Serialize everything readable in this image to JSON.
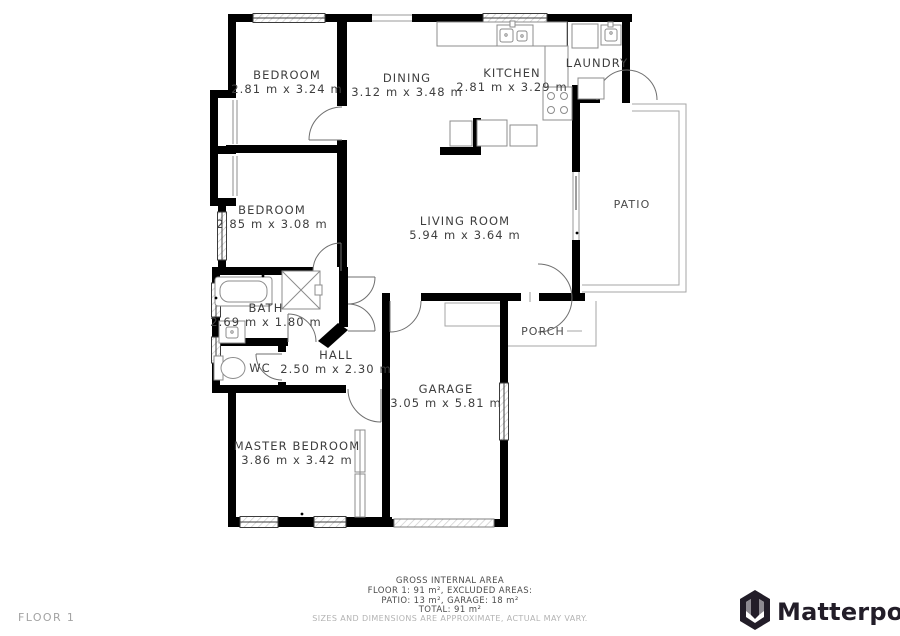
{
  "plan": {
    "rooms": [
      {
        "id": "bedroom-1",
        "name": "BEDROOM",
        "dims": "2.81 m x 3.24 m"
      },
      {
        "id": "dining",
        "name": "DINING",
        "dims": "3.12 m x 3.48 m"
      },
      {
        "id": "kitchen",
        "name": "KITCHEN",
        "dims": "2.81 m x 3.29 m"
      },
      {
        "id": "laundry",
        "name": "LAUNDRY",
        "dims": ""
      },
      {
        "id": "bedroom-2",
        "name": "BEDROOM",
        "dims": "2.85 m x 3.08 m"
      },
      {
        "id": "living-room",
        "name": "LIVING ROOM",
        "dims": "5.94 m x 3.64 m"
      },
      {
        "id": "patio",
        "name": "PATIO",
        "dims": ""
      },
      {
        "id": "bath",
        "name": "BATH",
        "dims": "2.69 m x 1.80 m"
      },
      {
        "id": "wc",
        "name": "WC",
        "dims": ""
      },
      {
        "id": "hall",
        "name": "HALL",
        "dims": "2.50 m x 2.30 m"
      },
      {
        "id": "porch",
        "name": "PORCH",
        "dims": ""
      },
      {
        "id": "garage",
        "name": "GARAGE",
        "dims": "3.05 m x 5.81 m"
      },
      {
        "id": "master-bedroom",
        "name": "MASTER BEDROOM",
        "dims": "3.86 m x 3.42 m"
      }
    ],
    "footer": {
      "title": "GROSS INTERNAL AREA",
      "area_line": "FLOOR 1: 91 m², EXCLUDED AREAS:",
      "excluded_line": "PATIO: 13 m², GARAGE: 18 m²",
      "total_line": "TOTAL: 91 m²",
      "disclaimer": "SIZES AND DIMENSIONS ARE APPROXIMATE, ACTUAL MAY VARY."
    },
    "floor_label": "FLOOR 1",
    "brand": "Matterport",
    "colors": {
      "wall": "#000000",
      "thin_line": "#8c8c8c",
      "text": "#3e3e3e",
      "muted": "#b3b3b3",
      "logo": "#221d28"
    }
  }
}
